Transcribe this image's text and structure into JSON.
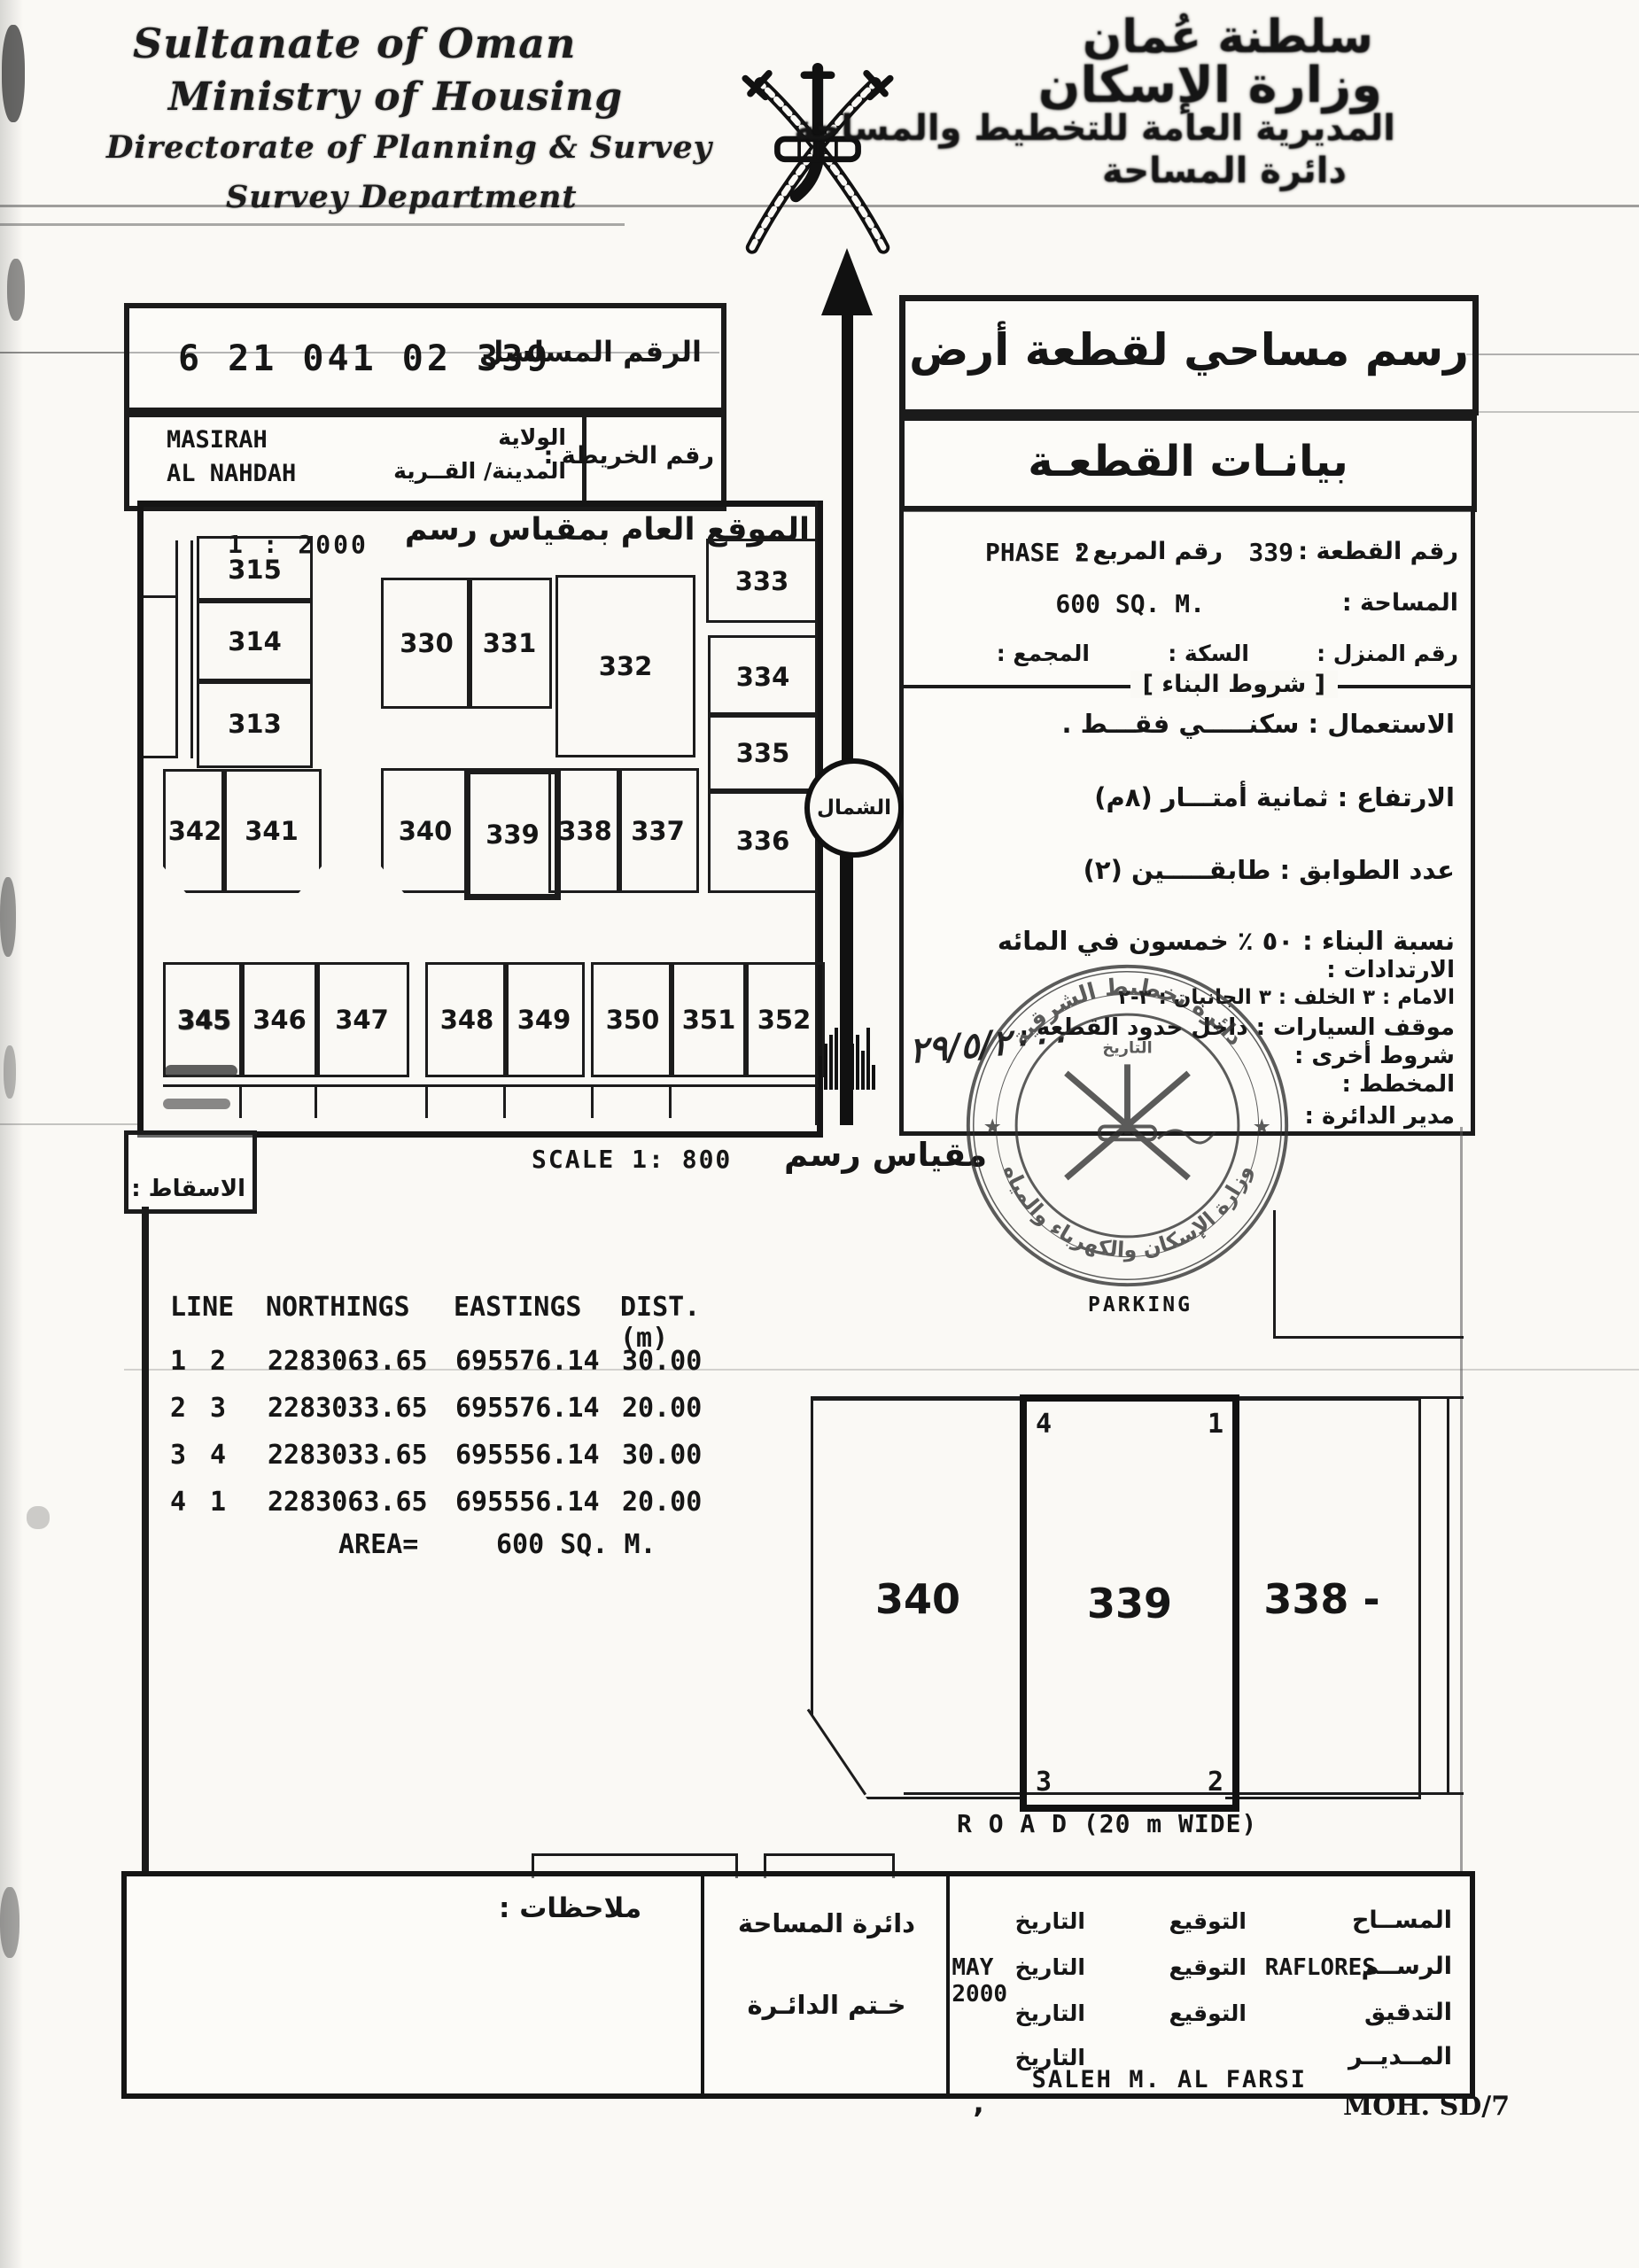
{
  "header": {
    "org_lines": [
      "Sultanate of Oman",
      "Ministry of Housing",
      "Directorate of Planning & Survey",
      "Survey Department"
    ],
    "org_lines_ar": [
      "سلطنة عُمان",
      "وزارة الإسكان",
      "المديرية العامة للتخطيط والمساحة",
      "دائرة المساحة"
    ]
  },
  "serial_box": {
    "label": "الرقم المسلسل",
    "value": "6 21 041 02 339"
  },
  "title_box": {
    "title": "رسم مساحي لقطعة أرض"
  },
  "location_box": {
    "wilayat_label": "الولاية",
    "wilayat": "MASIRAH",
    "town_label": "المدينة/ القــرية",
    "town": "AL NAHDAH",
    "map_no_label": "رقم الخريطة :"
  },
  "plot_header_box": {
    "title": "بيانـات القطعـة"
  },
  "plot_info": {
    "plot_no_label": "رقم القطعة :",
    "plot_no": "339",
    "square_label": "رقم المربع :",
    "square": "PHASE 2",
    "area_label": "المساحة :",
    "area": "600 SQ. M.",
    "house_label": "رقم المنزل :",
    "street_label": "السكة :",
    "complex_label": "المجمع :",
    "conditions_header": "[ شروط البناء ]"
  },
  "conditions": [
    {
      "text": "الاستعمال : سكنـــــي فقـــط .",
      "size": "lg"
    },
    {
      "text": "الارتفاع : ثمانية أمتـــار (٨م)",
      "size": "lg"
    },
    {
      "text": "عدد الطوابق : طابقـــــين (٢)",
      "size": "lg"
    },
    {
      "text": "نسبة البناء : ٥٠ ٪ خمسون في المائه",
      "size": "lg"
    },
    {
      "text": "الارتدادات :",
      "size": "md"
    },
    {
      "text": "الامام : ٣   الخلف : ٣   الجانبان : ٣-٢",
      "size": "sm"
    },
    {
      "text": "موقف السيارات : داخل حدود القطعه .",
      "size": "md"
    },
    {
      "text": "شروط أخرى :",
      "size": "md"
    },
    {
      "text": "المخطط :",
      "size": "md"
    },
    {
      "text": "مدير الدائرة :",
      "size": "md"
    }
  ],
  "handwritten_date": "٢٩/٥/٢٠٠٠",
  "stamp": {
    "outer_text": "وزارة الإسكان والكهرباء والمياه",
    "inner_text": "دائرة تخطيط الشرقية",
    "center_text": "التاريخ"
  },
  "north": {
    "label": "الشمال"
  },
  "overview_map": {
    "title": "الموقع العام بمقياس رسم",
    "scale": "1 : 2000",
    "highlighted_plot": "339",
    "plots": [
      {
        "id": "315"
      },
      {
        "id": "314"
      },
      {
        "id": "313"
      },
      {
        "id": "330"
      },
      {
        "id": "331"
      },
      {
        "id": "332"
      },
      {
        "id": "333"
      },
      {
        "id": "334"
      },
      {
        "id": "335"
      },
      {
        "id": "336"
      },
      {
        "id": "342"
      },
      {
        "id": "341"
      },
      {
        "id": "340"
      },
      {
        "id": "339"
      },
      {
        "id": "338"
      },
      {
        "id": "337"
      },
      {
        "id": "345"
      },
      {
        "id": "346"
      },
      {
        "id": "347"
      },
      {
        "id": "348"
      },
      {
        "id": "349"
      },
      {
        "id": "350"
      },
      {
        "id": "351"
      },
      {
        "id": "352"
      }
    ]
  },
  "projection_box": {
    "label": "الاسقاط :"
  },
  "scale_line": {
    "en": "SCALE 1: 800",
    "ar": "مقياس رسم"
  },
  "coords_table": {
    "headers": [
      "LINE",
      "NORTHINGS",
      "EASTINGS",
      "DIST. (m)"
    ],
    "rows": [
      {
        "from": "1",
        "to": "2",
        "northing": "2283063.65",
        "easting": "695576.14",
        "dist": "30.00"
      },
      {
        "from": "2",
        "to": "3",
        "northing": "2283033.65",
        "easting": "695576.14",
        "dist": "20.00"
      },
      {
        "from": "3",
        "to": "4",
        "northing": "2283033.65",
        "easting": "695556.14",
        "dist": "30.00"
      },
      {
        "from": "4",
        "to": "1",
        "northing": "2283063.65",
        "easting": "695556.14",
        "dist": "20.00"
      }
    ],
    "area_label": "AREA=",
    "area_value": "600 SQ. M."
  },
  "site_plan": {
    "parking": "PARKING",
    "road": "R O A D  (20 m WIDE)",
    "left_plot": "340",
    "center_plot": "339",
    "right_plot": "338 -",
    "corners": {
      "tl": "4",
      "tr": "1",
      "bl": "3",
      "br": "2"
    }
  },
  "footer": {
    "notes_label": "ملاحظات :",
    "dept_line1": "دائرة المساحة",
    "dept_line2": "خـتم الدائـرة",
    "sign_rows": [
      {
        "role": "المســاح",
        "sig_label": "التوقيع",
        "sig_value": "",
        "date_label": "التاريخ",
        "date_value": "",
        "name": ""
      },
      {
        "role": "الرســم",
        "sig_label": "التوقيع",
        "sig_value": "RAFLORES",
        "date_label": "التاريخ",
        "date_value": "MAY 2000",
        "name": ""
      },
      {
        "role": "التدقيق",
        "sig_label": "التوقيع",
        "sig_value": "",
        "date_label": "التاريخ",
        "date_value": "",
        "name": ""
      },
      {
        "role": "المــديــر",
        "sig_label": "",
        "sig_value": "",
        "date_label": "التاريخ",
        "date_value": "",
        "name": "SALEH M. AL FARSI"
      }
    ],
    "form_code": "MOH. SD/7"
  }
}
